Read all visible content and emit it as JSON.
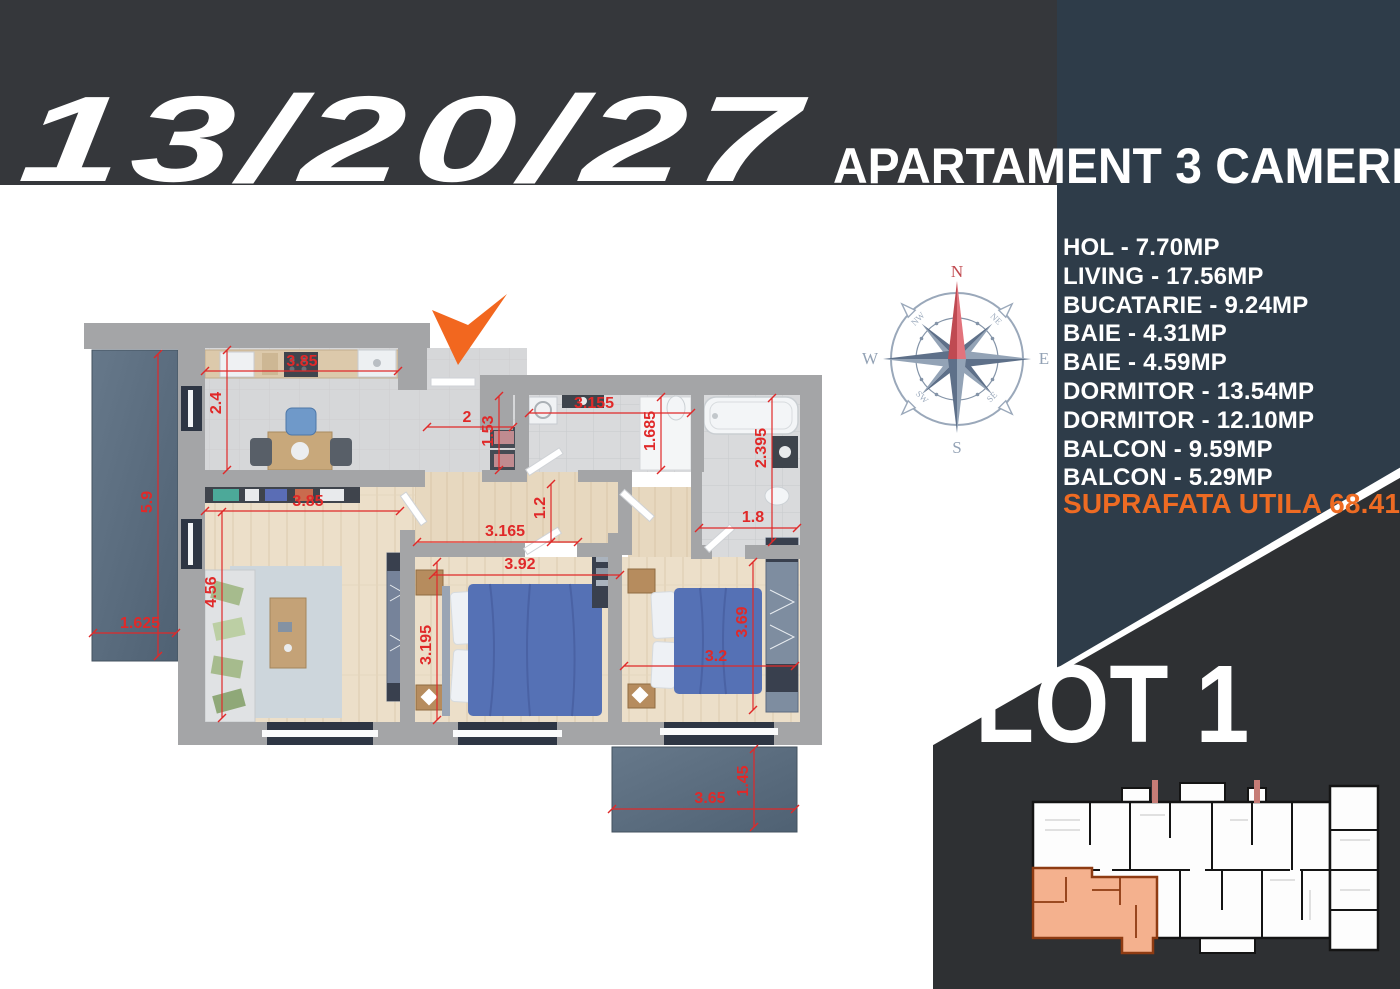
{
  "header": {
    "unit_numbers": "13/20/27",
    "apartment_title": "APARTAMENT 3 CAMERE"
  },
  "area_list": {
    "items": [
      "HOL - 7.70MP",
      "LIVING - 17.56MP",
      "BUCATARIE - 9.24MP",
      "BAIE - 4.31MP",
      "BAIE - 4.59MP",
      "DORMITOR - 13.54MP",
      "DORMITOR - 12.10MP",
      "BALCON - 9.59MP",
      "BALCON - 5.29MP"
    ],
    "total": "SUPRAFATA UTILA 68.41 MP"
  },
  "lot_label": "LOT 1",
  "compass": {
    "cardinal": {
      "n": "N",
      "e": "E",
      "s": "S",
      "w": "W"
    },
    "intercardinal": {
      "ne": "NE",
      "se": "SE",
      "sw": "SW",
      "nw": "NW"
    }
  },
  "floor_plan": {
    "dimensions": [
      {
        "text": "3.85",
        "x": 302,
        "y": 366,
        "rot": 0,
        "line": [
          205,
          371,
          398,
          371
        ]
      },
      {
        "text": "2.4",
        "x": 221,
        "y": 403,
        "rot": -90,
        "line": [
          227,
          350,
          227,
          470
        ]
      },
      {
        "text": "5.9",
        "x": 152,
        "y": 502,
        "rot": -90,
        "line": [
          158,
          354,
          158,
          656
        ]
      },
      {
        "text": "1.625",
        "x": 140,
        "y": 628,
        "rot": 0,
        "line": [
          93,
          633,
          176,
          633
        ]
      },
      {
        "text": "3.85",
        "x": 308,
        "y": 506,
        "rot": 0,
        "line": [
          205,
          511,
          400,
          511
        ]
      },
      {
        "text": "4.56",
        "x": 216,
        "y": 592,
        "rot": -90,
        "line": [
          222,
          512,
          222,
          718
        ]
      },
      {
        "text": "2",
        "x": 467,
        "y": 422,
        "rot": 0,
        "line": [
          427,
          427,
          513,
          427
        ]
      },
      {
        "text": "1.53",
        "x": 493,
        "y": 431,
        "rot": -90,
        "line": [
          499,
          396,
          499,
          470
        ]
      },
      {
        "text": "3.155",
        "x": 594,
        "y": 408,
        "rot": 0,
        "line": [
          529,
          413,
          691,
          413
        ]
      },
      {
        "text": "1.685",
        "x": 655,
        "y": 431,
        "rot": -90,
        "line": [
          661,
          397,
          661,
          470
        ]
      },
      {
        "text": "2.395",
        "x": 766,
        "y": 448,
        "rot": -90,
        "line": [
          772,
          398,
          772,
          542
        ]
      },
      {
        "text": "1.8",
        "x": 753,
        "y": 522,
        "rot": 0,
        "line": [
          699,
          528,
          797,
          528
        ]
      },
      {
        "text": "1.2",
        "x": 545,
        "y": 508,
        "rot": -90,
        "line": [
          551,
          484,
          551,
          542
        ]
      },
      {
        "text": "3.165",
        "x": 505,
        "y": 536,
        "rot": 0,
        "line": [
          417,
          542,
          578,
          542
        ]
      },
      {
        "text": "3.92",
        "x": 520,
        "y": 569,
        "rot": 0,
        "line": [
          433,
          575,
          620,
          575
        ]
      },
      {
        "text": "3.195",
        "x": 431,
        "y": 645,
        "rot": -90,
        "line": [
          437,
          562,
          437,
          720
        ]
      },
      {
        "text": "3.2",
        "x": 716,
        "y": 661,
        "rot": 0,
        "line": [
          624,
          666,
          795,
          666
        ]
      },
      {
        "text": "3.69",
        "x": 747,
        "y": 622,
        "rot": -90,
        "line": [
          753,
          562,
          753,
          710
        ]
      },
      {
        "text": "3.65",
        "x": 710,
        "y": 803,
        "rot": 0,
        "line": [
          612,
          809,
          795,
          809
        ]
      },
      {
        "text": "1.45",
        "x": 748,
        "y": 781,
        "rot": -90,
        "line": [
          754,
          749,
          754,
          827
        ]
      }
    ]
  },
  "colors": {
    "band": "#35373b",
    "panel": "#2e3c49",
    "lot_shape": "#2e3033",
    "accent_orange": "#ee6b23",
    "dimension_red": "#e02929",
    "highlight_apartment": "#f4b18e"
  }
}
